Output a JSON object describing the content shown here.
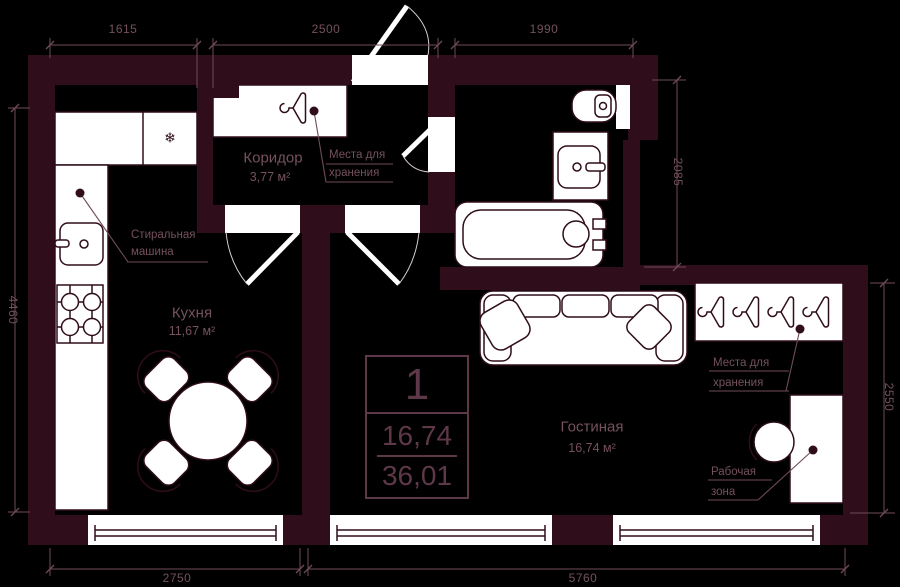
{
  "colors": {
    "background": "#000000",
    "wall": "#2f0d1b",
    "line": "#6f4b58",
    "text": "#74515d",
    "stamp": "#5e3848",
    "arc": "#d9ced2",
    "fixture": "#ffffff"
  },
  "icons": {
    "snowflake": "❄"
  },
  "dimensions": {
    "top_left": "1615",
    "top_middle": "2500",
    "top_right": "1990",
    "left": "4460",
    "right_bathroom": "2085",
    "right_living": "2550",
    "bottom_left": "2750",
    "bottom_right": "5760"
  },
  "rooms": {
    "kitchen": {
      "name": "Кухня",
      "area": "11,67 м²"
    },
    "corridor": {
      "name": "Коридор",
      "area": "3,77 м²"
    },
    "living": {
      "name": "Гостиная",
      "area": "16,74 м²"
    }
  },
  "stamp": {
    "room_count": "1",
    "living_area": "16,74",
    "total_area": "36,01"
  },
  "labels": {
    "washing_machine": {
      "line1": "Стиральная",
      "line2": "машина"
    },
    "storage_corridor": {
      "line1": "Места для",
      "line2": "хранения"
    },
    "storage_living": {
      "line1": "Места для",
      "line2": "хранения"
    },
    "work_zone": {
      "line1": "Рабочая",
      "line2": "зона"
    }
  }
}
